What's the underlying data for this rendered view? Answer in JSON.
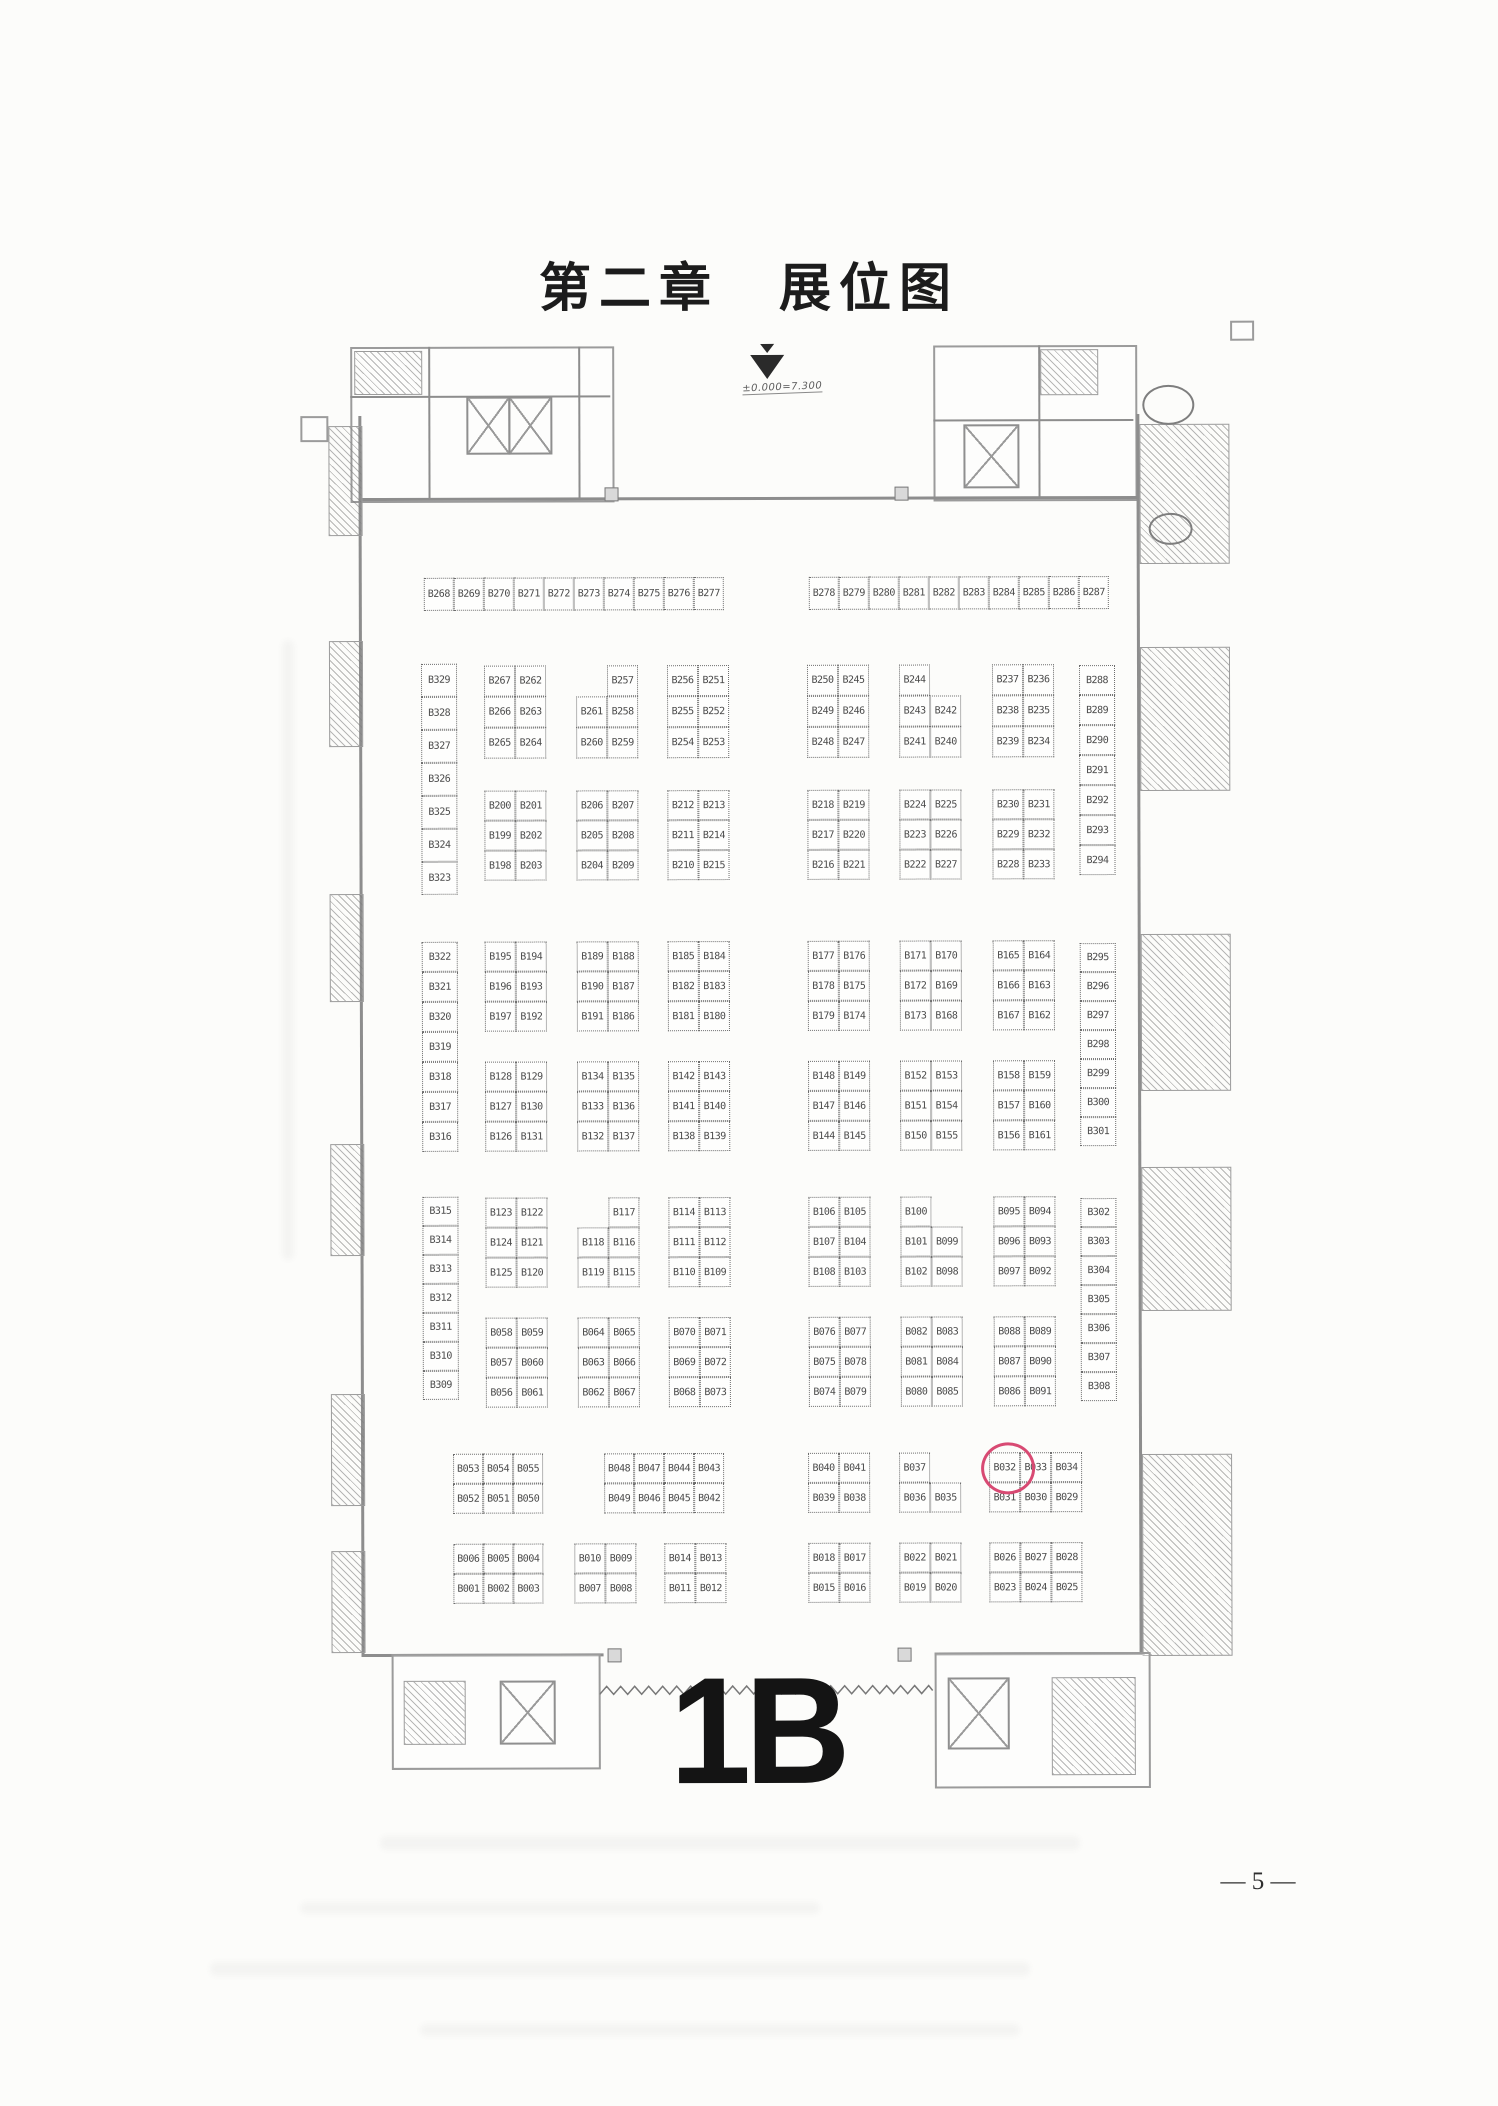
{
  "document": {
    "title": "第二章　展位图",
    "hall_label": "1B",
    "page_number": "— 5 —",
    "elevation_note": "±0.000=7.300"
  },
  "colors": {
    "highlight_circle": "#d84a73",
    "ink": "#3f3f3f",
    "wall": "#8d8d8d"
  },
  "highlight": {
    "booth": "B032"
  },
  "islands": [
    {
      "name": "strip-top-left",
      "x": 425,
      "y": 577,
      "cw": 30,
      "ch": 33,
      "rows": [
        [
          "B268",
          "B269",
          "B270",
          "B271",
          "B272",
          "B273",
          "B274",
          "B275",
          "B276",
          "B277"
        ]
      ]
    },
    {
      "name": "strip-top-right",
      "x": 810,
      "y": 577,
      "cw": 30,
      "ch": 33,
      "rows": [
        [
          "B278",
          "B279",
          "B280",
          "B281",
          "B282",
          "B283",
          "B284",
          "B285",
          "B286",
          "B287"
        ]
      ]
    },
    {
      "name": "left-wall-booths-1",
      "x": 422,
      "y": 663,
      "cw": 36,
      "ch": 33,
      "rows": [
        [
          "B329"
        ],
        [
          "B328"
        ],
        [
          "B327"
        ],
        [
          "B326"
        ],
        [
          "B325"
        ],
        [
          "B324"
        ],
        [
          "B323"
        ]
      ]
    },
    {
      "name": "left-wall-booths-2",
      "x": 422,
      "y": 941,
      "cw": 36,
      "ch": 30,
      "rows": [
        [
          "B322"
        ],
        [
          "B321"
        ],
        [
          "B320"
        ],
        [
          "B319"
        ],
        [
          "B318"
        ],
        [
          "B317"
        ],
        [
          "B316"
        ]
      ]
    },
    {
      "name": "left-wall-booths-3",
      "x": 422,
      "y": 1196,
      "cw": 36,
      "ch": 29,
      "rows": [
        [
          "B315"
        ],
        [
          "B314"
        ],
        [
          "B313"
        ],
        [
          "B312"
        ],
        [
          "B311"
        ],
        [
          "B310"
        ],
        [
          "B309"
        ]
      ]
    },
    {
      "name": "right-wall-booths-1",
      "x": 1080,
      "y": 666,
      "cw": 36,
      "ch": 30,
      "rows": [
        [
          "B288"
        ],
        [
          "B289"
        ],
        [
          "B290"
        ],
        [
          "B291"
        ],
        [
          "B292"
        ],
        [
          "B293"
        ],
        [
          "B294"
        ]
      ]
    },
    {
      "name": "right-wall-booths-2",
      "x": 1080,
      "y": 944,
      "cw": 36,
      "ch": 29,
      "rows": [
        [
          "B295"
        ],
        [
          "B296"
        ],
        [
          "B297"
        ],
        [
          "B298"
        ],
        [
          "B299"
        ],
        [
          "B300"
        ],
        [
          "B301"
        ]
      ]
    },
    {
      "name": "right-wall-booths-3",
      "x": 1080,
      "y": 1199,
      "cw": 36,
      "ch": 29,
      "rows": [
        [
          "B302"
        ],
        [
          "B303"
        ],
        [
          "B304"
        ],
        [
          "B305"
        ],
        [
          "B306"
        ],
        [
          "B307"
        ],
        [
          "B308"
        ]
      ]
    },
    {
      "x": 485,
      "y": 665,
      "ch": 31,
      "rows": [
        [
          "B267",
          "B262"
        ],
        [
          "B266",
          "B263"
        ],
        [
          "B265",
          "B264"
        ]
      ]
    },
    {
      "x": 577,
      "y": 665,
      "ch": 31,
      "rows": [
        [
          "",
          "B257"
        ],
        [
          "B261",
          "B258"
        ],
        [
          "B260",
          "B259"
        ]
      ]
    },
    {
      "x": 668,
      "y": 665,
      "ch": 31,
      "rows": [
        [
          "B256",
          "B251"
        ],
        [
          "B255",
          "B252"
        ],
        [
          "B254",
          "B253"
        ]
      ]
    },
    {
      "x": 808,
      "y": 665,
      "ch": 31,
      "rows": [
        [
          "B250",
          "B245"
        ],
        [
          "B249",
          "B246"
        ],
        [
          "B248",
          "B247"
        ]
      ]
    },
    {
      "x": 900,
      "y": 665,
      "ch": 31,
      "rows": [
        [
          "B244",
          ""
        ],
        [
          "B243",
          "B242"
        ],
        [
          "B241",
          "B240"
        ]
      ]
    },
    {
      "x": 993,
      "y": 665,
      "ch": 31,
      "rows": [
        [
          "B237",
          "B236"
        ],
        [
          "B238",
          "B235"
        ],
        [
          "B239",
          "B234"
        ]
      ]
    },
    {
      "x": 485,
      "y": 790,
      "rows": [
        [
          "B200",
          "B201"
        ],
        [
          "B199",
          "B202"
        ],
        [
          "B198",
          "B203"
        ]
      ]
    },
    {
      "x": 577,
      "y": 790,
      "rows": [
        [
          "B206",
          "B207"
        ],
        [
          "B205",
          "B208"
        ],
        [
          "B204",
          "B209"
        ]
      ]
    },
    {
      "x": 668,
      "y": 790,
      "rows": [
        [
          "B212",
          "B213"
        ],
        [
          "B211",
          "B214"
        ],
        [
          "B210",
          "B215"
        ]
      ]
    },
    {
      "x": 808,
      "y": 790,
      "rows": [
        [
          "B218",
          "B219"
        ],
        [
          "B217",
          "B220"
        ],
        [
          "B216",
          "B221"
        ]
      ]
    },
    {
      "x": 900,
      "y": 790,
      "rows": [
        [
          "B224",
          "B225"
        ],
        [
          "B223",
          "B226"
        ],
        [
          "B222",
          "B227"
        ]
      ]
    },
    {
      "x": 993,
      "y": 790,
      "rows": [
        [
          "B230",
          "B231"
        ],
        [
          "B229",
          "B232"
        ],
        [
          "B228",
          "B233"
        ]
      ]
    },
    {
      "x": 485,
      "y": 941,
      "rows": [
        [
          "B195",
          "B194"
        ],
        [
          "B196",
          "B193"
        ],
        [
          "B197",
          "B192"
        ]
      ]
    },
    {
      "x": 577,
      "y": 941,
      "rows": [
        [
          "B189",
          "B188"
        ],
        [
          "B190",
          "B187"
        ],
        [
          "B191",
          "B186"
        ]
      ]
    },
    {
      "x": 668,
      "y": 941,
      "rows": [
        [
          "B185",
          "B184"
        ],
        [
          "B182",
          "B183"
        ],
        [
          "B181",
          "B180"
        ]
      ]
    },
    {
      "x": 808,
      "y": 941,
      "rows": [
        [
          "B177",
          "B176"
        ],
        [
          "B178",
          "B175"
        ],
        [
          "B179",
          "B174"
        ]
      ]
    },
    {
      "x": 900,
      "y": 941,
      "rows": [
        [
          "B171",
          "B170"
        ],
        [
          "B172",
          "B169"
        ],
        [
          "B173",
          "B168"
        ]
      ]
    },
    {
      "x": 993,
      "y": 941,
      "rows": [
        [
          "B165",
          "B164"
        ],
        [
          "B166",
          "B163"
        ],
        [
          "B167",
          "B162"
        ]
      ]
    },
    {
      "x": 485,
      "y": 1061,
      "rows": [
        [
          "B128",
          "B129"
        ],
        [
          "B127",
          "B130"
        ],
        [
          "B126",
          "B131"
        ]
      ]
    },
    {
      "x": 577,
      "y": 1061,
      "rows": [
        [
          "B134",
          "B135"
        ],
        [
          "B133",
          "B136"
        ],
        [
          "B132",
          "B137"
        ]
      ]
    },
    {
      "x": 668,
      "y": 1061,
      "rows": [
        [
          "B142",
          "B143"
        ],
        [
          "B141",
          "B140"
        ],
        [
          "B138",
          "B139"
        ]
      ]
    },
    {
      "x": 808,
      "y": 1061,
      "rows": [
        [
          "B148",
          "B149"
        ],
        [
          "B147",
          "B146"
        ],
        [
          "B144",
          "B145"
        ]
      ]
    },
    {
      "x": 900,
      "y": 1061,
      "rows": [
        [
          "B152",
          "B153"
        ],
        [
          "B151",
          "B154"
        ],
        [
          "B150",
          "B155"
        ]
      ]
    },
    {
      "x": 993,
      "y": 1061,
      "rows": [
        [
          "B158",
          "B159"
        ],
        [
          "B157",
          "B160"
        ],
        [
          "B156",
          "B161"
        ]
      ]
    },
    {
      "x": 485,
      "y": 1197,
      "rows": [
        [
          "B123",
          "B122"
        ],
        [
          "B124",
          "B121"
        ],
        [
          "B125",
          "B120"
        ]
      ]
    },
    {
      "x": 577,
      "y": 1197,
      "rows": [
        [
          "",
          "B117"
        ],
        [
          "B118",
          "B116"
        ],
        [
          "B119",
          "B115"
        ]
      ]
    },
    {
      "x": 668,
      "y": 1197,
      "rows": [
        [
          "B114",
          "B113"
        ],
        [
          "B111",
          "B112"
        ],
        [
          "B110",
          "B109"
        ]
      ]
    },
    {
      "x": 808,
      "y": 1197,
      "rows": [
        [
          "B106",
          "B105"
        ],
        [
          "B107",
          "B104"
        ],
        [
          "B108",
          "B103"
        ]
      ]
    },
    {
      "x": 900,
      "y": 1197,
      "rows": [
        [
          "B100",
          ""
        ],
        [
          "B101",
          "B099"
        ],
        [
          "B102",
          "B098"
        ]
      ]
    },
    {
      "x": 993,
      "y": 1197,
      "rows": [
        [
          "B095",
          "B094"
        ],
        [
          "B096",
          "B093"
        ],
        [
          "B097",
          "B092"
        ]
      ]
    },
    {
      "x": 485,
      "y": 1317,
      "rows": [
        [
          "B058",
          "B059"
        ],
        [
          "B057",
          "B060"
        ],
        [
          "B056",
          "B061"
        ]
      ]
    },
    {
      "x": 577,
      "y": 1317,
      "rows": [
        [
          "B064",
          "B065"
        ],
        [
          "B063",
          "B066"
        ],
        [
          "B062",
          "B067"
        ]
      ]
    },
    {
      "x": 668,
      "y": 1317,
      "rows": [
        [
          "B070",
          "B071"
        ],
        [
          "B069",
          "B072"
        ],
        [
          "B068",
          "B073"
        ]
      ]
    },
    {
      "x": 808,
      "y": 1317,
      "rows": [
        [
          "B076",
          "B077"
        ],
        [
          "B075",
          "B078"
        ],
        [
          "B074",
          "B079"
        ]
      ]
    },
    {
      "x": 900,
      "y": 1317,
      "rows": [
        [
          "B082",
          "B083"
        ],
        [
          "B081",
          "B084"
        ],
        [
          "B080",
          "B085"
        ]
      ]
    },
    {
      "x": 993,
      "y": 1317,
      "rows": [
        [
          "B088",
          "B089"
        ],
        [
          "B087",
          "B090"
        ],
        [
          "B086",
          "B091"
        ]
      ]
    },
    {
      "x": 452,
      "y": 1453,
      "cw": 30,
      "rows": [
        [
          "B053",
          "B054",
          "B055"
        ],
        [
          "B052",
          "B051",
          "B050"
        ]
      ]
    },
    {
      "x": 603,
      "y": 1453,
      "cw": 30,
      "rows": [
        [
          "B048",
          "B047",
          "B044",
          "B043"
        ],
        [
          "B049",
          "B046",
          "B045",
          "B042"
        ]
      ]
    },
    {
      "x": 807,
      "y": 1453,
      "rows": [
        [
          "B040",
          "B041"
        ],
        [
          "B039",
          "B038"
        ]
      ]
    },
    {
      "x": 898,
      "y": 1453,
      "rows": [
        [
          "B037",
          ""
        ],
        [
          "B036",
          "B035"
        ]
      ]
    },
    {
      "x": 988,
      "y": 1453,
      "rows": [
        [
          "B032",
          "B033",
          "B034"
        ],
        [
          "B031",
          "B030",
          "B029"
        ]
      ]
    },
    {
      "x": 452,
      "y": 1543,
      "cw": 30,
      "rows": [
        [
          "B006",
          "B005",
          "B004"
        ],
        [
          "B001",
          "B002",
          "B003"
        ]
      ]
    },
    {
      "x": 573,
      "y": 1543,
      "rows": [
        [
          "B010",
          "B009"
        ],
        [
          "B007",
          "B008"
        ]
      ]
    },
    {
      "x": 663,
      "y": 1543,
      "rows": [
        [
          "B014",
          "B013"
        ],
        [
          "B011",
          "B012"
        ]
      ]
    },
    {
      "x": 807,
      "y": 1543,
      "rows": [
        [
          "B018",
          "B017"
        ],
        [
          "B015",
          "B016"
        ]
      ]
    },
    {
      "x": 898,
      "y": 1543,
      "rows": [
        [
          "B022",
          "B021"
        ],
        [
          "B019",
          "B020"
        ]
      ]
    },
    {
      "x": 988,
      "y": 1543,
      "rows": [
        [
          "B026",
          "B027",
          "B028"
        ],
        [
          "B023",
          "B024",
          "B025"
        ]
      ]
    }
  ]
}
